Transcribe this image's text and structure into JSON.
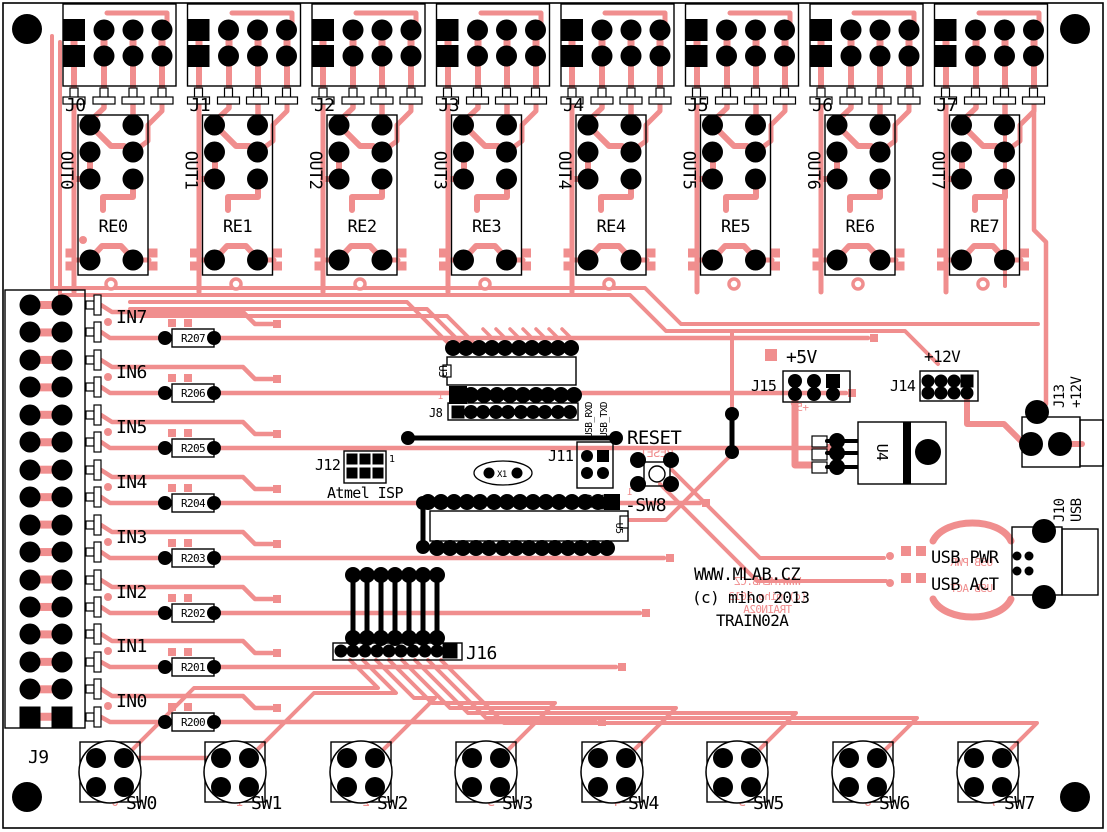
{
  "colors": {
    "trace": "#F08E8E",
    "silk": "#000000",
    "board": "#FFFFFF"
  },
  "relay_blocks": [
    {
      "connector": "J0",
      "out": "OUT0",
      "relay": "RE0"
    },
    {
      "connector": "J1",
      "out": "OUT1",
      "relay": "RE1"
    },
    {
      "connector": "J2",
      "out": "OUT2",
      "relay": "RE2"
    },
    {
      "connector": "J3",
      "out": "OUT3",
      "relay": "RE3"
    },
    {
      "connector": "J4",
      "out": "OUT4",
      "relay": "RE4"
    },
    {
      "connector": "J5",
      "out": "OUT5",
      "relay": "RE5"
    },
    {
      "connector": "J6",
      "out": "OUT6",
      "relay": "RE6"
    },
    {
      "connector": "J7",
      "out": "OUT7",
      "relay": "RE7"
    }
  ],
  "inputs": [
    {
      "label": "IN7",
      "resistor": "R207",
      "digit": "7"
    },
    {
      "label": "IN6",
      "resistor": "R206",
      "digit": "6"
    },
    {
      "label": "IN5",
      "resistor": "R205",
      "digit": "5"
    },
    {
      "label": "IN4",
      "resistor": "R204",
      "digit": "4"
    },
    {
      "label": "IN3",
      "resistor": "R203",
      "digit": "3"
    },
    {
      "label": "IN2",
      "resistor": "R202",
      "digit": "2"
    },
    {
      "label": "IN1",
      "resistor": "R201",
      "digit": "1"
    },
    {
      "label": "IN0",
      "resistor": "R200",
      "digit": "0"
    }
  ],
  "left_connector": {
    "label": "J9"
  },
  "jumper_header": {
    "label": "J16"
  },
  "switches": [
    {
      "label": "SW0",
      "digit": "0"
    },
    {
      "label": "SW1",
      "digit": "1"
    },
    {
      "label": "SW2",
      "digit": "2"
    },
    {
      "label": "SW3",
      "digit": "3"
    },
    {
      "label": "SW4",
      "digit": "4"
    },
    {
      "label": "SW5",
      "digit": "5"
    },
    {
      "label": "SW6",
      "digit": "6"
    },
    {
      "label": "SW7",
      "digit": "7"
    }
  ],
  "mcu": {
    "u3": "U3",
    "j8": "J8",
    "pin1": "1",
    "u5": "U5"
  },
  "isp": {
    "label": "J12",
    "pin1": "1",
    "name": "Atmel ISP"
  },
  "crystal": {
    "label": "X1"
  },
  "serial": {
    "label": "J11",
    "top": [
      "USB_RXD",
      "USB_TXD"
    ],
    "bottom": [
      "TXD",
      "RXD"
    ]
  },
  "reset": {
    "label": "RESET",
    "button": "-SW8",
    "pin1": "1"
  },
  "power": {
    "plus5": "+5V",
    "j15": "J15",
    "plus12": "+12V",
    "j14": "J14",
    "regulator": "U4",
    "jack": "J13",
    "jack_voltage": "+12V"
  },
  "usb": {
    "label": "J10",
    "type": "USB",
    "pwr": "USB PWR",
    "act": "USB ACT"
  },
  "branding": {
    "site": "WWW.MLAB.CZ",
    "copyright": "(c) miho 2013",
    "product": "TRAIN02A"
  }
}
